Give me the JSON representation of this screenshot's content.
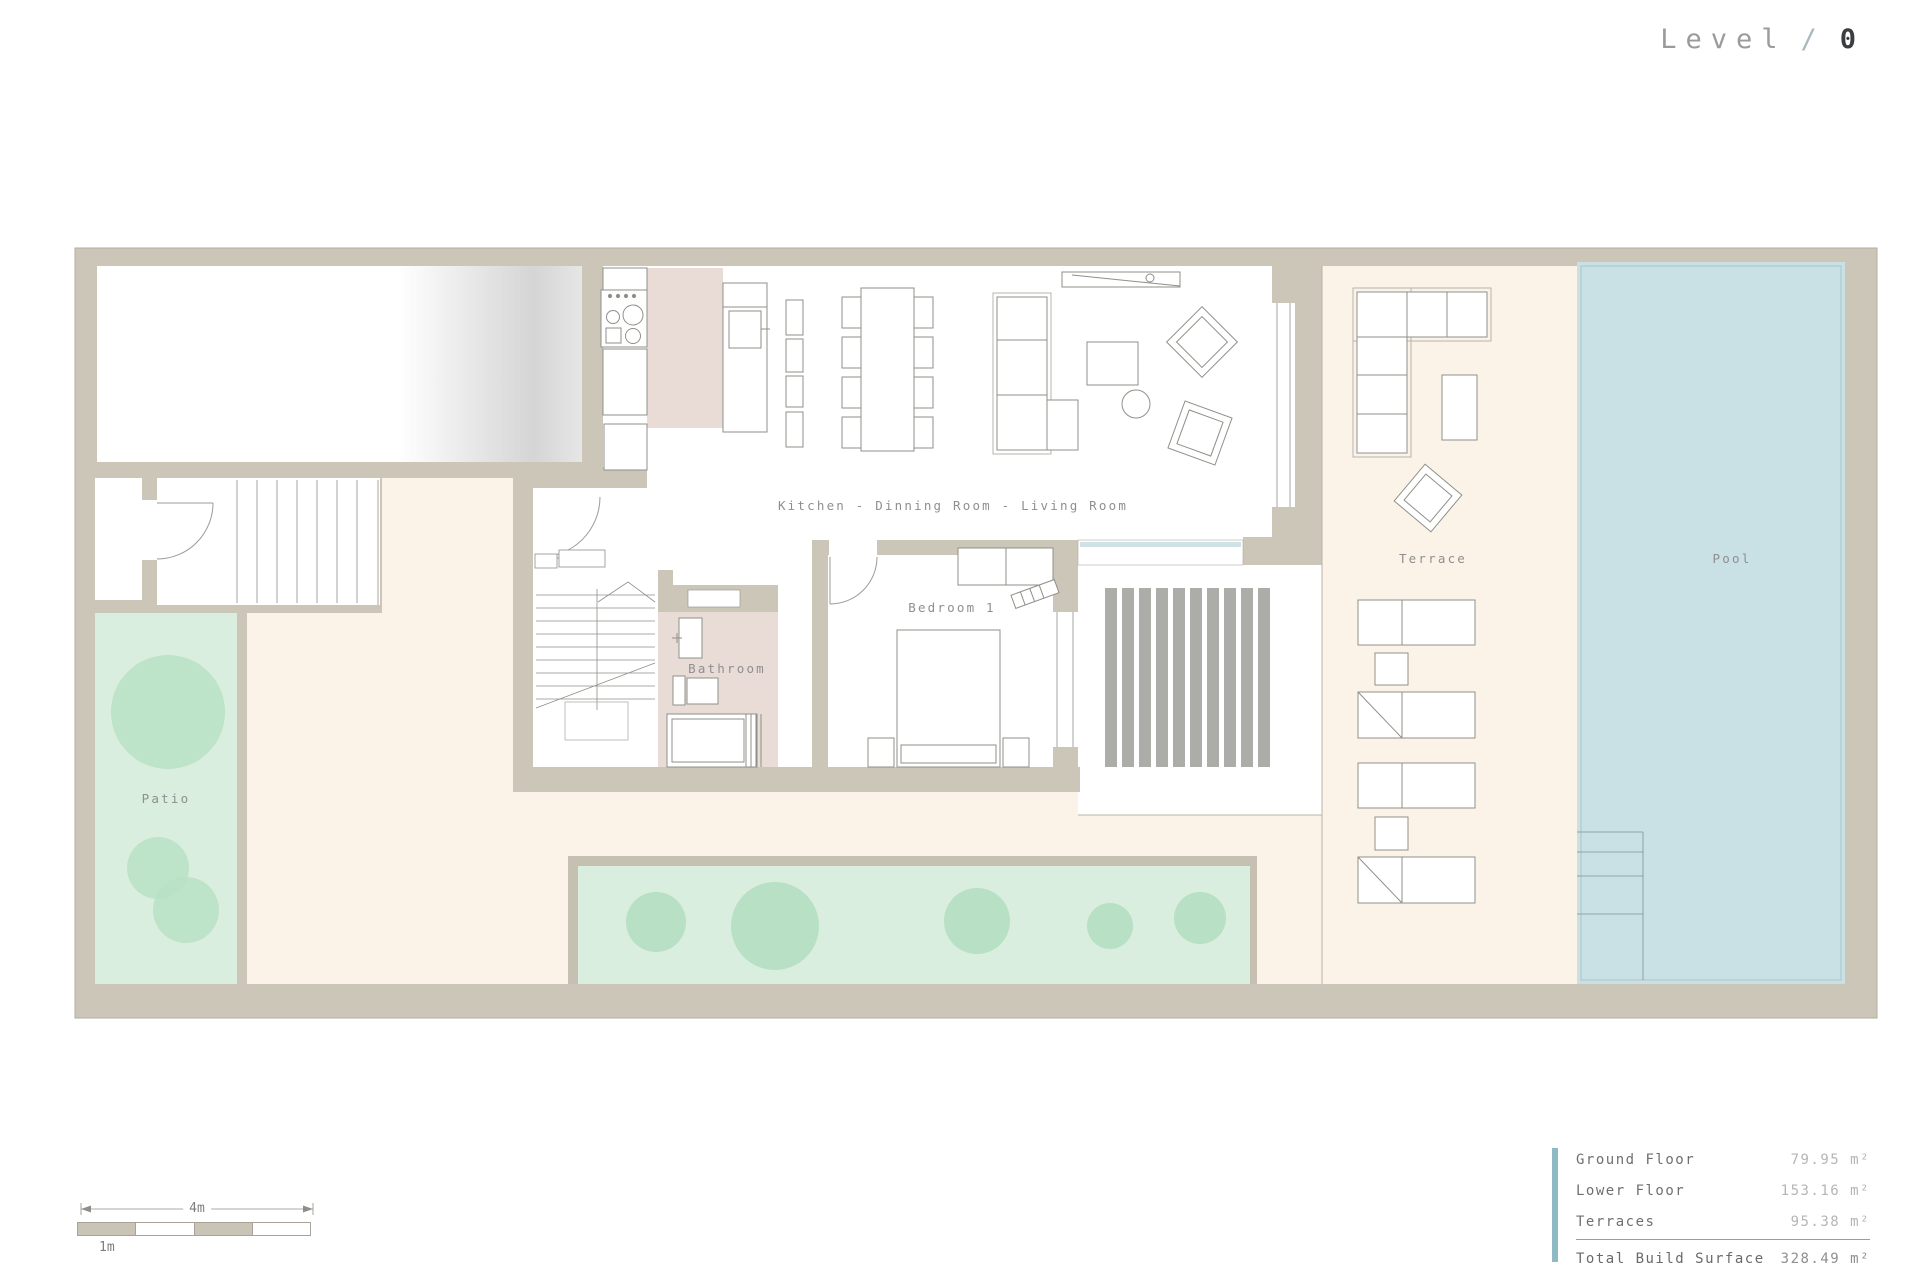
{
  "title": {
    "word": "Level",
    "sep": "/",
    "value": "0"
  },
  "plan": {
    "rooms": {
      "kitchen_living": "Kitchen - Dinning Room - Living Room",
      "bedroom": "Bedroom 1",
      "bathroom": "Bathroom",
      "patio": "Patio",
      "terrace": "Terrace",
      "pool": "Pool"
    }
  },
  "scale_bar": {
    "major_label": "4m",
    "minor_label": "1m"
  },
  "area_table": {
    "rows": [
      {
        "label": "Ground Floor",
        "value": "79.95 m²"
      },
      {
        "label": "Lower Floor",
        "value": "153.16 m²"
      },
      {
        "label": "Terraces",
        "value": "95.38 m²"
      }
    ],
    "total": {
      "label": "Total Build Surface",
      "value": "328.49 m²"
    }
  },
  "colors": {
    "accent_bar": "#8fb9c3",
    "wall": "#cbc6b8",
    "cream_floor": "#fcf3e8",
    "pool_water": "#c9e0e5",
    "patio_green": "#d9eede",
    "bush_green": "#b7e0c4",
    "wet_room_pink": "#e9dcd6",
    "deck_stripe": "#acaca8"
  }
}
